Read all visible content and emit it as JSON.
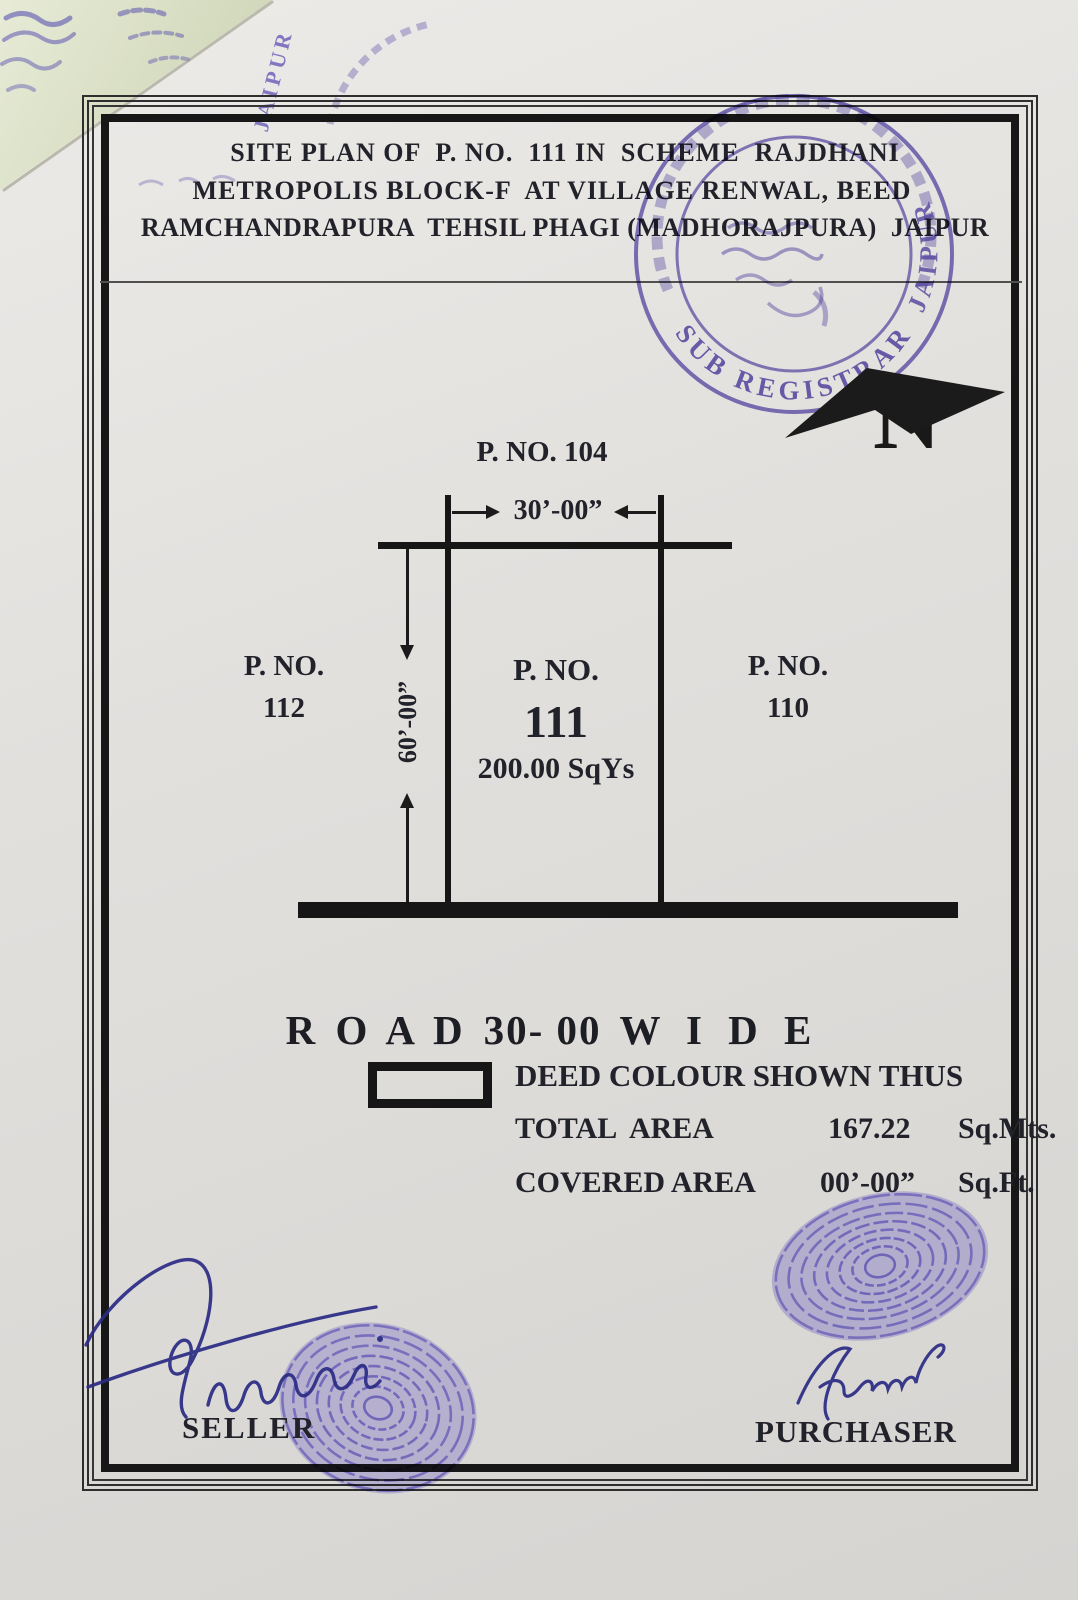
{
  "page": {
    "colors": {
      "paper": "#e3e1de",
      "ink": "#1b1b1b",
      "stamp_purple": "#5a4bb4",
      "fingerprint_purple": "#6456d8",
      "signature_blue": "#2b2b85",
      "overlapping_paper_green": "#dfe4cd"
    },
    "title": {
      "line1": "SITE PLAN OF  P. NO.  111 IN  SCHEME  RAJDHANI",
      "line2": "METROPOLIS BLOCK-F  AT VILLAGE RENWAL, BEED",
      "line3": "RAMCHANDRAPURA  TEHSIL PHAGI (MADHORAJPURA)  JAIPUR"
    },
    "compass": {
      "north_label": "N"
    },
    "diagram": {
      "top_plot_label": "P. NO. 104",
      "width_dim": "30’-00”",
      "height_dim": "60’-00”",
      "left_plot": {
        "line1": "P. NO.",
        "line2": "112"
      },
      "center_plot": {
        "line1": "P. NO.",
        "line2": "111",
        "area": "200.00 SqYs"
      },
      "right_plot": {
        "line1": "P. NO.",
        "line2": "110"
      },
      "road_label": {
        "part1": "R O A D",
        "part2": "30- 00",
        "part3": "W I D E"
      }
    },
    "legend": {
      "deed_text": "DEED COLOUR SHOWN THUS",
      "rows": [
        {
          "label": "TOTAL  AREA",
          "value": "167.22",
          "unit": "Sq.Mts."
        },
        {
          "label": "COVERED AREA",
          "value": "00’-00”",
          "unit": "Sq.Ft."
        }
      ]
    },
    "signatures": {
      "seller_label": "SELLER",
      "purchaser_label": "PURCHASER"
    },
    "stamps": {
      "registrar_arc_bottom": "SUB REGISTRAR",
      "registrar_arc_side": "JAIPUR",
      "corner_stamp_text": "JAIPUR"
    }
  }
}
